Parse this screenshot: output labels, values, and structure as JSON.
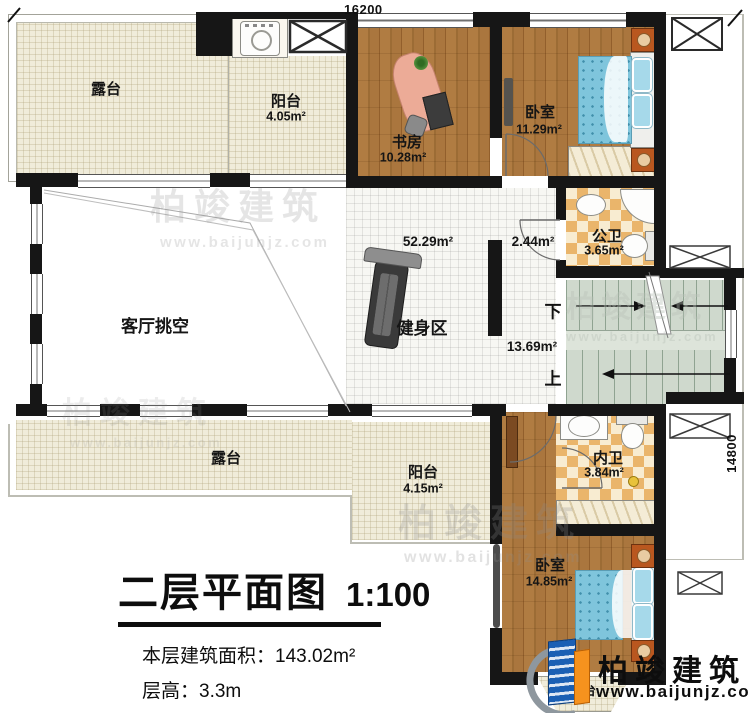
{
  "dimensions": {
    "top": "16200",
    "right": "14800"
  },
  "rooms": {
    "terrace_top": {
      "name": "露台"
    },
    "balcony_top": {
      "name": "阳台",
      "area": "4.05m²"
    },
    "study": {
      "name": "书房",
      "area": "10.28m²"
    },
    "bedroom_top": {
      "name": "卧室",
      "area": "11.29m²"
    },
    "bath_public": {
      "name": "公卫",
      "area": "3.65m²"
    },
    "living_void": {
      "name": "客厅挑空"
    },
    "gym": {
      "name": "健身区"
    },
    "hall": {
      "area": "52.29m²"
    },
    "corridor": {
      "area": "2.44m²"
    },
    "stairwell": {
      "area": "13.69m²"
    },
    "terrace_bottom": {
      "name": "露台"
    },
    "balcony_bottom": {
      "name": "阳台",
      "area": "4.15m²"
    },
    "bath_ensuite": {
      "name": "内卫",
      "area": "3.84m²"
    },
    "bedroom_bottom": {
      "name": "卧室",
      "area": "14.85m²"
    },
    "terrace_bay": {
      "name": "露台"
    }
  },
  "stairs": {
    "down": "下",
    "up": "上"
  },
  "title_block": {
    "title": "二层平面图",
    "scale": "1:100",
    "area_label": "本层建筑面积：",
    "area_value": "143.02m²",
    "height_label": "层高：",
    "height_value": "3.3m"
  },
  "branding": {
    "name": "柏竣建筑",
    "website": "www.baijunjz.com"
  },
  "watermark": {
    "name": "柏竣建筑",
    "website": "www.baijunjz.com"
  },
  "colors": {
    "wall": "#161616",
    "wood": "#a9733c",
    "terrace": "#f0ecda",
    "tile": "#f7f7f3",
    "stair": "#cfd9cd",
    "tile_dark": "#eab56b",
    "tile_light": "#f8ecd1",
    "bed": "#7fc5dc",
    "brand_blue": "#1a5fb4",
    "brand_orange": "#f6921e"
  }
}
